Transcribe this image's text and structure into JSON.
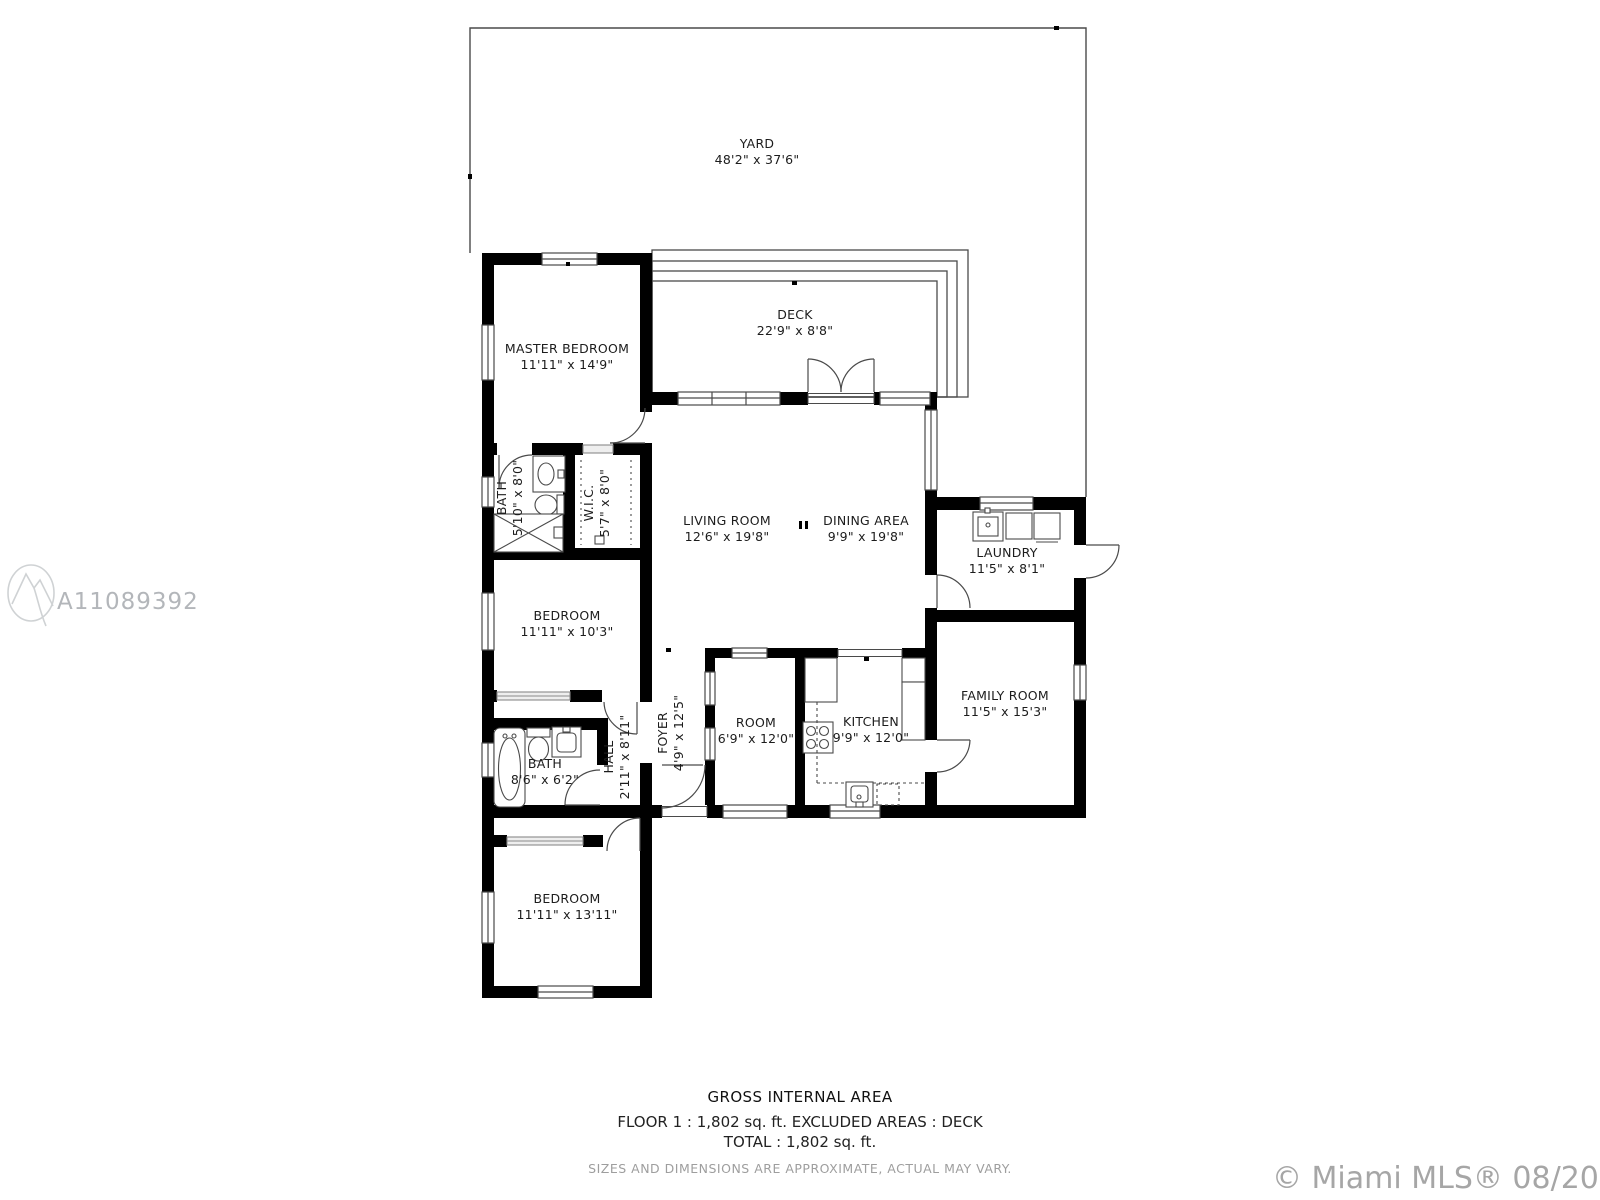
{
  "rooms": [
    {
      "id": "yard",
      "name": "YARD",
      "dims": "48'2\" x 37'6\""
    },
    {
      "id": "deck",
      "name": "DECK",
      "dims": "22'9\" x 8'8\""
    },
    {
      "id": "master-bedroom",
      "name": "MASTER BEDROOM",
      "dims": "11'11\" x 14'9\""
    },
    {
      "id": "bath-1",
      "name": "BATH",
      "dims": "5'10\" x 8'0\""
    },
    {
      "id": "wic",
      "name": "W.I.C.",
      "dims": "5'7\" x 8'0\""
    },
    {
      "id": "living-room",
      "name": "LIVING ROOM",
      "dims": "12'6\" x 19'8\""
    },
    {
      "id": "dining-area",
      "name": "DINING AREA",
      "dims": "9'9\" x 19'8\""
    },
    {
      "id": "laundry",
      "name": "LAUNDRY",
      "dims": "11'5\" x 8'1\""
    },
    {
      "id": "bedroom-1",
      "name": "BEDROOM",
      "dims": "11'11\" x 10'3\""
    },
    {
      "id": "family-room",
      "name": "FAMILY ROOM",
      "dims": "11'5\" x 15'3\""
    },
    {
      "id": "foyer",
      "name": "FOYER",
      "dims": "4'9\" x 12'5\""
    },
    {
      "id": "hall",
      "name": "HALL",
      "dims": "2'11\" x 8'11\""
    },
    {
      "id": "bath-2",
      "name": "BATH",
      "dims": "8'6\" x 6'2\""
    },
    {
      "id": "room",
      "name": "ROOM",
      "dims": "6'9\" x 12'0\""
    },
    {
      "id": "kitchen",
      "name": "KITCHEN",
      "dims": "9'9\" x 12'0\""
    },
    {
      "id": "bedroom-2",
      "name": "BEDROOM",
      "dims": "11'11\" x 13'11\""
    }
  ],
  "footer": {
    "title": "GROSS INTERNAL AREA",
    "line1": "FLOOR 1 : 1,802 sq. ft. EXCLUDED AREAS : DECK",
    "line2": "TOTAL : 1,802 sq. ft.",
    "disclaimer": "SIZES AND DIMENSIONS ARE APPROXIMATE, ACTUAL MAY VARY."
  },
  "watermark": {
    "mls_id": "A11089392",
    "copyright": "© Miami MLS® 08/2021"
  },
  "colors": {
    "wall": "#000000",
    "line": "#4a4a4a",
    "muted": "#9e9e9e",
    "watermark": "#b3b6ba"
  }
}
